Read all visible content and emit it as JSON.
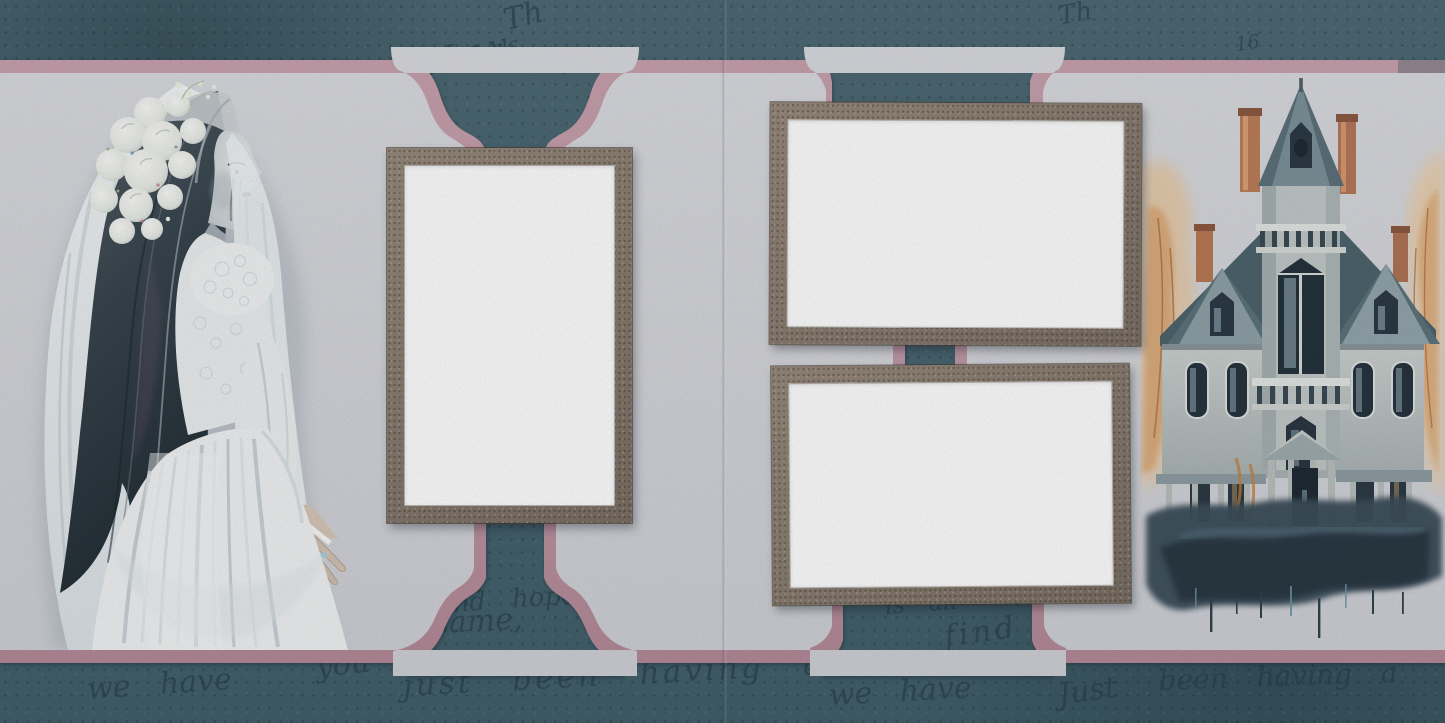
{
  "meta": {
    "title": "Gothic bride & haunted house scrapbook quick-page spread",
    "canvas": {
      "width": 1445,
      "height": 723
    },
    "pages": [
      {
        "side": "left",
        "illustration": "ghost-bride",
        "photo_slots": 1
      },
      {
        "side": "right",
        "illustration": "haunted-house",
        "photo_slots": 2
      }
    ]
  },
  "palette": {
    "background_teal": "#4a6671",
    "mat_pink": "#bf95a3",
    "panel_gray": "#d6d7db",
    "frame_taupe": "#877b6f",
    "photo_white": "#ffffff",
    "script_ink": "#2c4a58",
    "house_slate": "#556b76",
    "autumn_orange": "#d89a5e"
  },
  "photo_placeholders": [
    {
      "id": "left-portrait",
      "orientation": "portrait"
    },
    {
      "id": "right-top-landscape",
      "orientation": "landscape"
    },
    {
      "id": "right-bottom-landscape",
      "orientation": "landscape"
    }
  ],
  "decorative_script": {
    "items": [
      {
        "text": "Th"
      },
      {
        "text": "16"
      },
      {
        "text": "May"
      },
      {
        "text": "18"
      },
      {
        "text": "Th"
      },
      {
        "text": "16"
      },
      {
        "text": "and hope"
      },
      {
        "text": "you"
      },
      {
        "text": "the same,"
      },
      {
        "text": "we have"
      },
      {
        "text": "just been having a"
      },
      {
        "text": "is all"
      },
      {
        "text": "find"
      },
      {
        "text": "we have"
      },
      {
        "text": "Just"
      },
      {
        "text": "been having a"
      }
    ]
  }
}
